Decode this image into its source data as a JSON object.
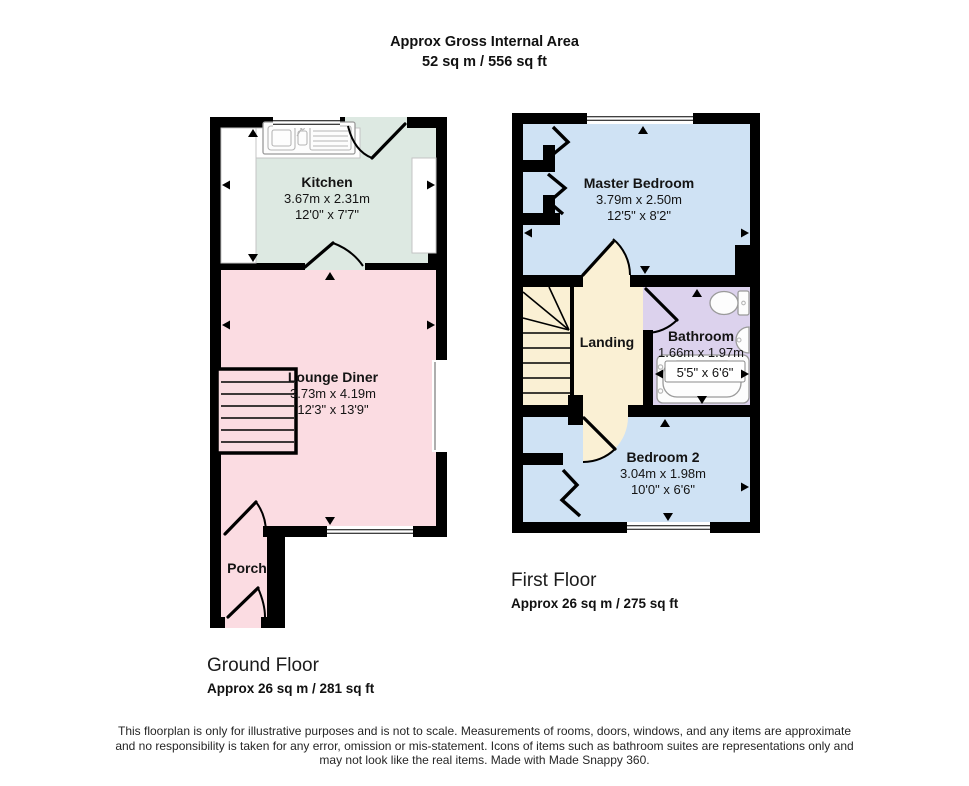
{
  "header": {
    "line1": "Approx Gross Internal Area",
    "line2": "52 sq m / 556 sq ft"
  },
  "floors": {
    "ground": {
      "label": "Ground Floor",
      "area": "Approx 26 sq m / 281 sq ft",
      "rooms": {
        "kitchen": {
          "name": "Kitchen",
          "metric": "3.67m x 2.31m",
          "imperial": "12'0\" x 7'7\""
        },
        "lounge": {
          "name": "Lounge Diner",
          "metric": "3.73m x 4.19m",
          "imperial": "12'3\" x 13'9\""
        },
        "porch": {
          "name": "Porch"
        }
      }
    },
    "first": {
      "label": "First Floor",
      "area": "Approx 26 sq m / 275 sq ft",
      "rooms": {
        "master": {
          "name": "Master Bedroom",
          "metric": "3.79m x 2.50m",
          "imperial": "12'5\" x 8'2\""
        },
        "landing": {
          "name": "Landing"
        },
        "bathroom": {
          "name": "Bathroom",
          "metric": "1.66m x 1.97m",
          "imperial": "5'5\" x 6'6\""
        },
        "bedroom2": {
          "name": "Bedroom 2",
          "metric": "3.04m x 1.98m",
          "imperial": "10'0\" x 6'6\""
        }
      }
    }
  },
  "colors": {
    "wall": "#000000",
    "kitchen": "#dde9e2",
    "lounge": "#fbdce2",
    "bedroom": "#cfe2f4",
    "landing": "#faf0d4",
    "bathroom": "#dcd2ed"
  },
  "footer": {
    "line1": "This floorplan is only for illustrative purposes and is not to scale. Measurements of rooms, doors, windows, and any items are approximate",
    "line2": "and no responsibility is taken for any error, omission or mis-statement. Icons of items such as bathroom suites are representations only and",
    "line3": "may not look like the real items. Made with Made Snappy 360."
  }
}
